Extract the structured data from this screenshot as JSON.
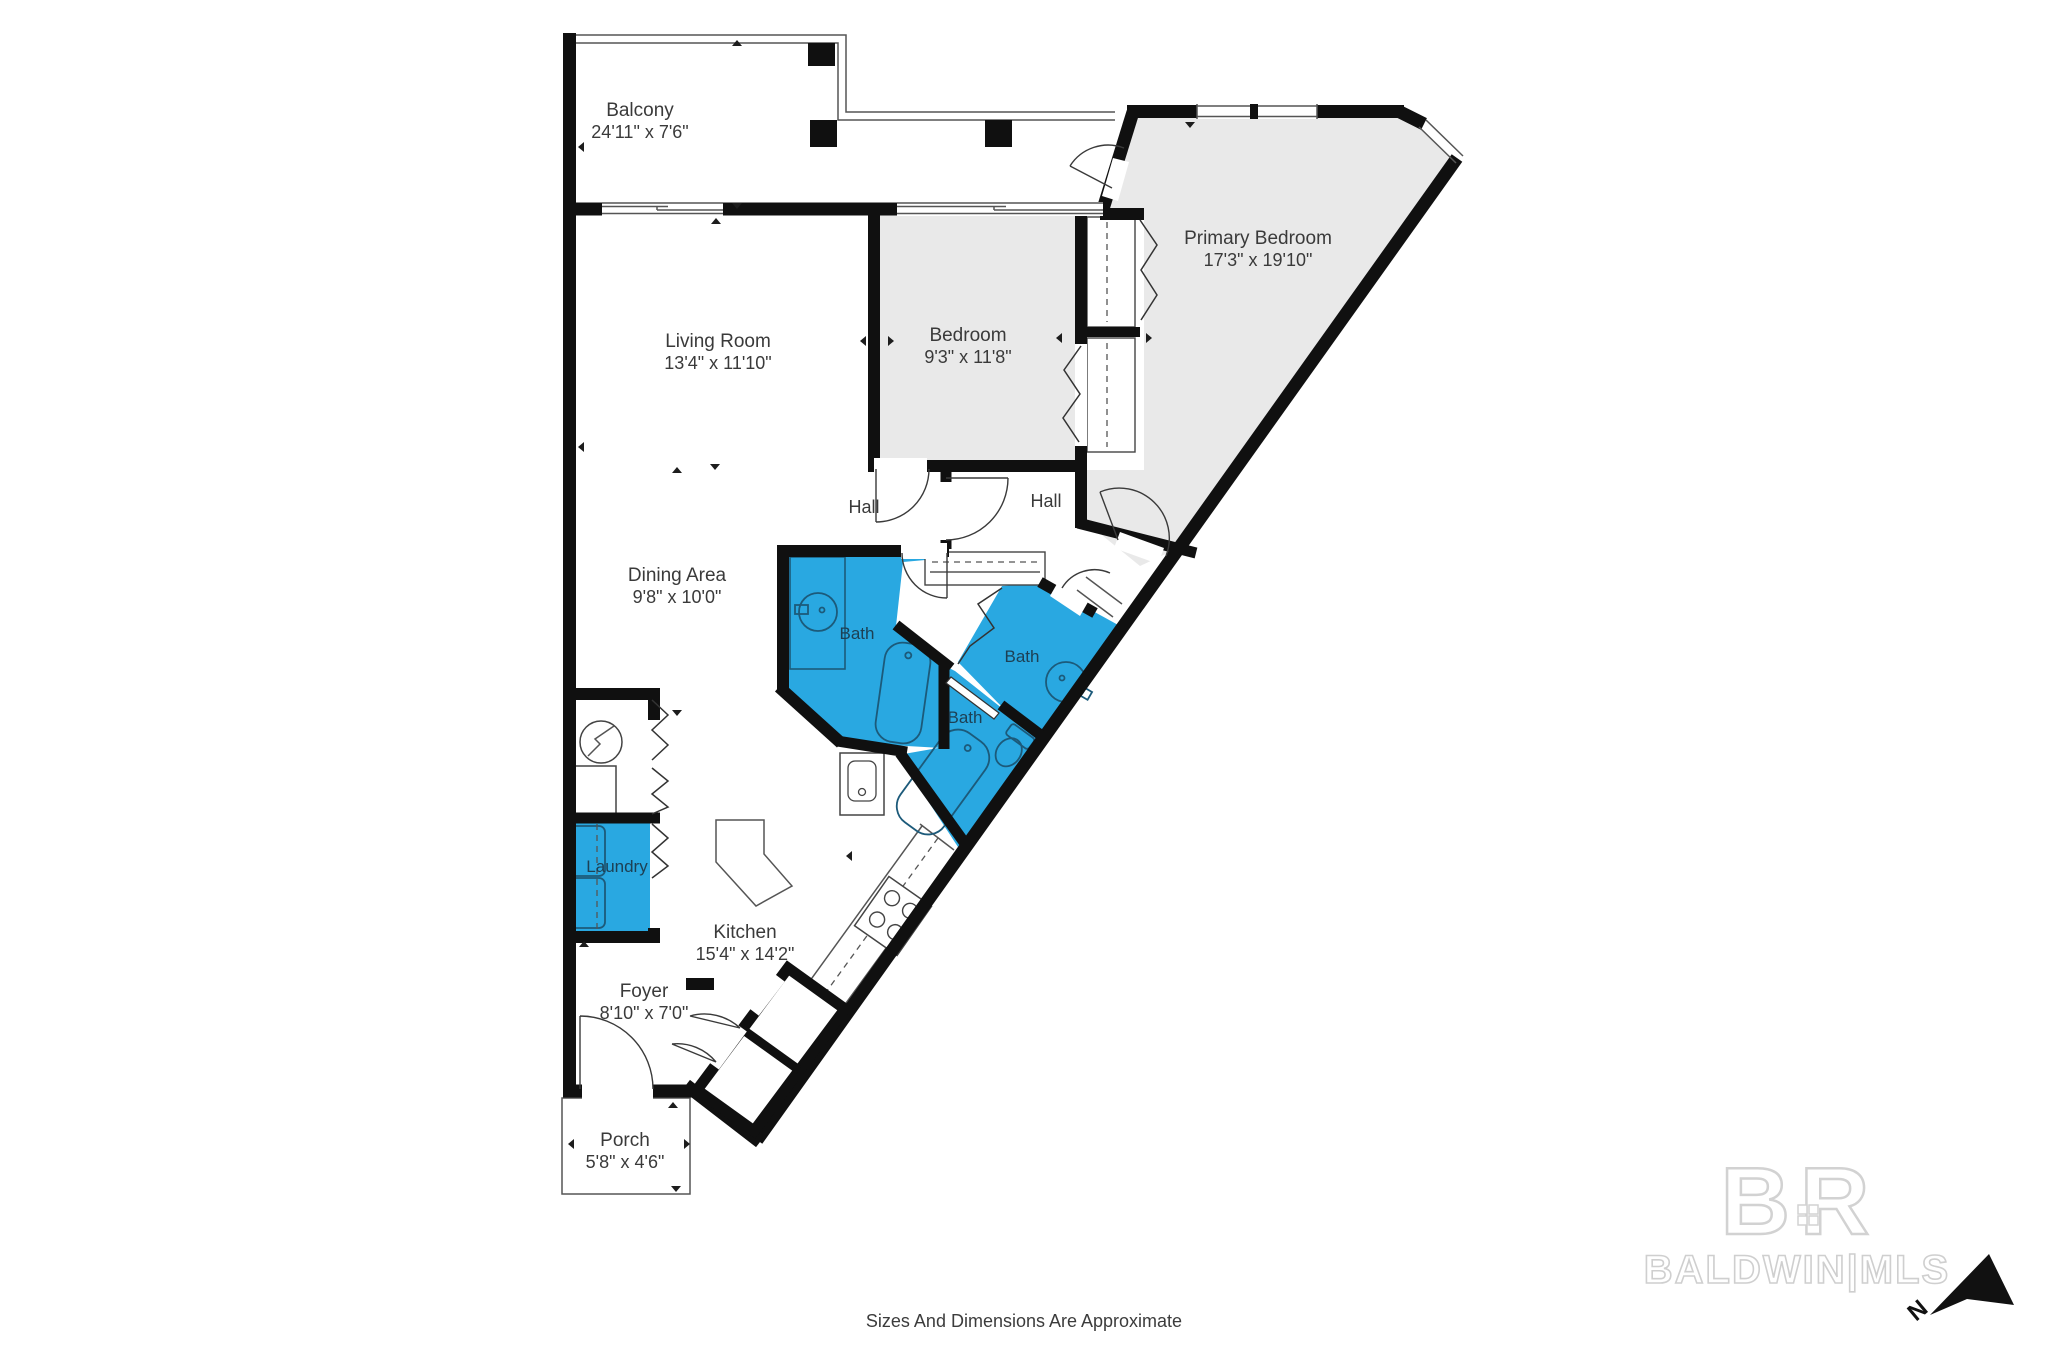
{
  "rooms": {
    "balcony": {
      "name": "Balcony",
      "dims": "24'11\" x 7'6\""
    },
    "living_room": {
      "name": "Living Room",
      "dims": "13'4\" x 11'10\""
    },
    "bedroom": {
      "name": "Bedroom",
      "dims": "9'3\" x 11'8\""
    },
    "primary_bedroom": {
      "name": "Primary Bedroom",
      "dims": "17'3\" x 19'10\""
    },
    "dining_area": {
      "name": "Dining Area",
      "dims": "9'8\" x 10'0\""
    },
    "kitchen": {
      "name": "Kitchen",
      "dims": "15'4\" x 14'2\""
    },
    "foyer": {
      "name": "Foyer",
      "dims": "8'10\" x 7'0\""
    },
    "porch": {
      "name": "Porch",
      "dims": "5'8\" x 4'6\""
    },
    "hall_left": {
      "name": "Hall"
    },
    "hall_right": {
      "name": "Hall"
    },
    "bath_hall": {
      "name": "Bath"
    },
    "bath_primary": {
      "name": "Bath"
    },
    "bath_middle": {
      "name": "Bath"
    },
    "laundry": {
      "name": "Laundry"
    }
  },
  "footer": {
    "disclaimer": "Sizes And Dimensions Are Approximate"
  },
  "watermark": {
    "monogram": "BR",
    "name": "BALDWIN|MLS"
  },
  "compass": {
    "north": "N"
  },
  "colors": {
    "bath_blue": "#29A8E1",
    "room_gray": "#E9E9E9",
    "wall_black": "#101010",
    "watermark_gray": "#D2D2D2"
  }
}
